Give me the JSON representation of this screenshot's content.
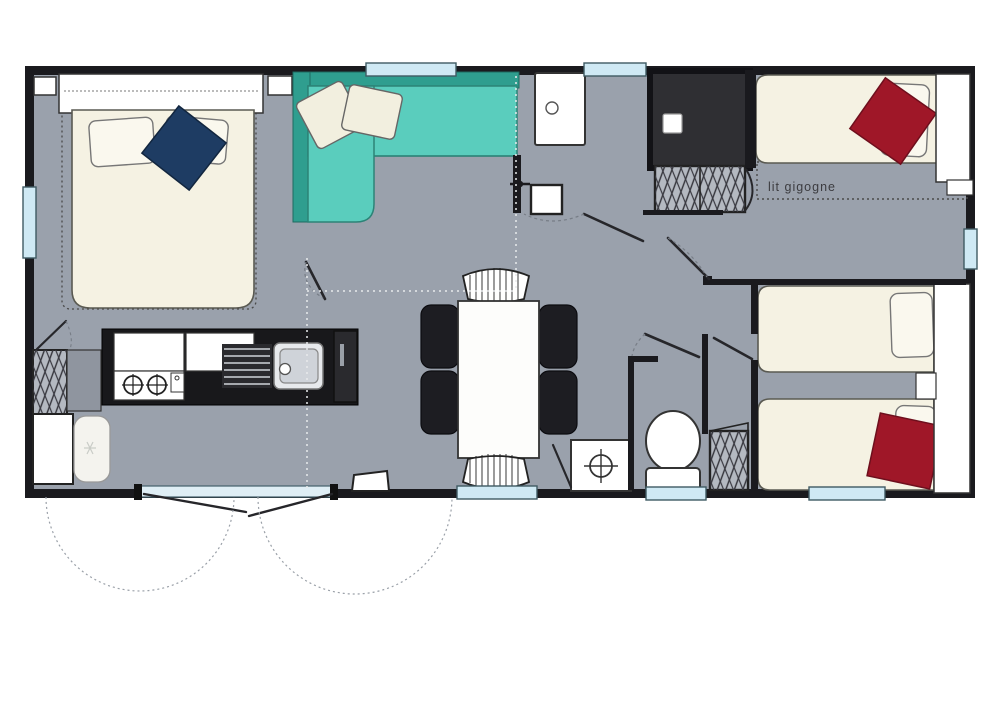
{
  "page": {
    "background": "#ffffff",
    "kind": "floor-plan"
  },
  "labels": {
    "trundle_bed": "lit gigogne"
  },
  "colors": {
    "wall": "#1a1a1e",
    "floor": "#9aa1ac",
    "sofa": "#5acdbd",
    "sofa_back": "#2f9e8f",
    "bed_cream": "#f5f2e3",
    "pillow": "#faf8ee",
    "cushion_navy": "#1e3c63",
    "cushion_red": "#9f1728",
    "window_glass": "#cfe9f4",
    "shower_dark": "#2f2f33",
    "counter_black": "#18181b",
    "chair_black": "#1d1d22",
    "wardrobe_gray": "#b4b9c1",
    "dash_gray": "#4a4a4a",
    "label_text": "#3c3c40"
  },
  "elements": [
    "double-bed",
    "headboard-shelf",
    "navy-cushion",
    "bed-dashed-outline",
    "corner-sofa",
    "sofa-cushions",
    "kitchen-counter",
    "kitchen-cabinets",
    "gas-hob",
    "draining-board",
    "kitchen-sink",
    "tall-appliance",
    "refrigerator",
    "storage-closet-kitchen",
    "storage-closet-hall",
    "storage-closet-wc",
    "dining-table",
    "dining-chair-1",
    "dining-chair-2",
    "dining-chair-3",
    "dining-chair-4",
    "stool-top",
    "stool-bottom",
    "shower",
    "shower-drain",
    "washbasin-unit",
    "water-heater",
    "toilet",
    "wc-washbasin",
    "single-bed-1",
    "single-bed-2",
    "single-bed-3",
    "red-cushion-1",
    "red-cushion-2",
    "trundle-bed-outline",
    "trundle-bed-label",
    "window-top-sofa",
    "window-top-shower",
    "window-left",
    "window-right",
    "window-bottom-1",
    "window-bottom-2",
    "window-bottom-3",
    "french-doors",
    "entry-door",
    "door-swing-arcs",
    "interior-door-leaves",
    "partition-dashed-lines"
  ]
}
